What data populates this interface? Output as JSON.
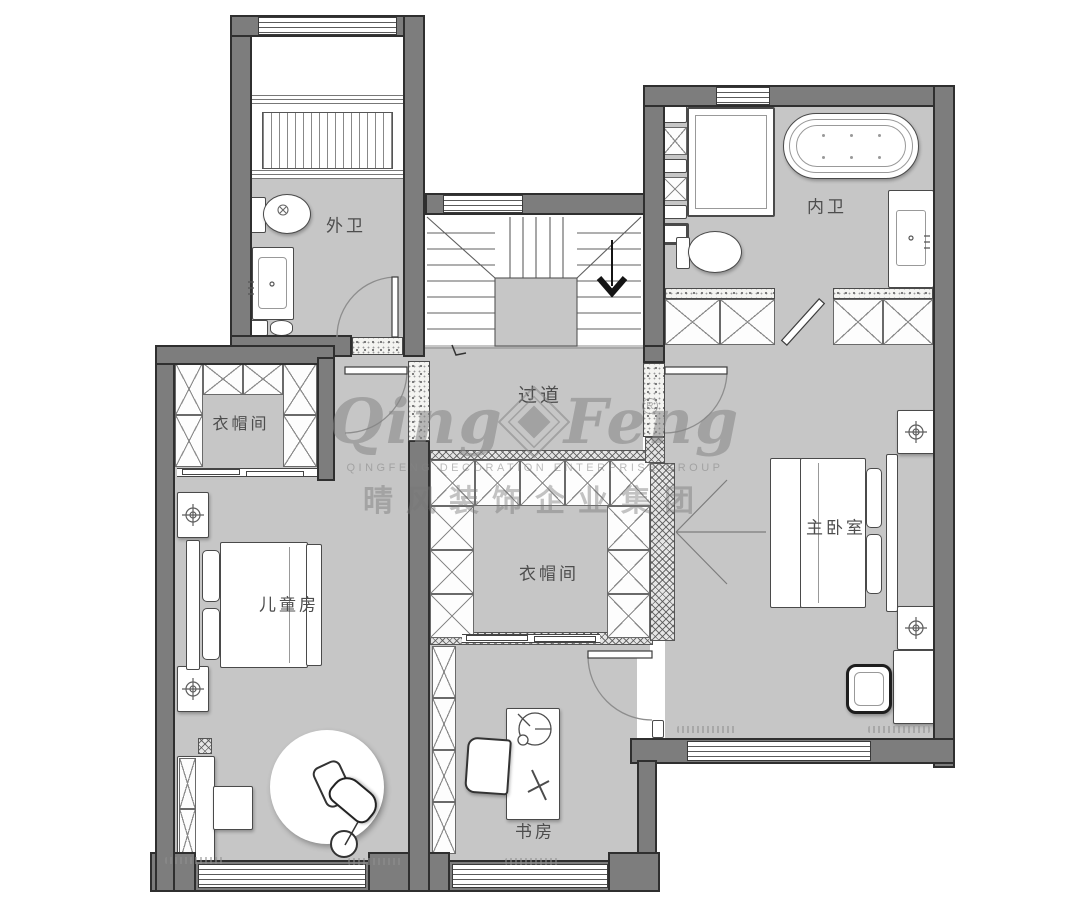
{
  "rooms": {
    "outer_bath": "外卫",
    "inner_bath": "内卫",
    "hallway": "过道",
    "cloak_left": "衣帽间",
    "cloak_center": "衣帽间",
    "master_bedroom": "主卧室",
    "kids_room": "儿童房",
    "study": "书房"
  },
  "watermark": {
    "script_left": "Qing",
    "script_right": "Feng",
    "line_en": "QINGFENG DECORATION ENTERPRISE GROUP",
    "line_cn": "晴风装饰企业集团",
    "registered": "R"
  },
  "colors": {
    "wall": "#7d7d7d",
    "wall-edge": "#2f2f2f",
    "floor": "#c6c6c6"
  }
}
